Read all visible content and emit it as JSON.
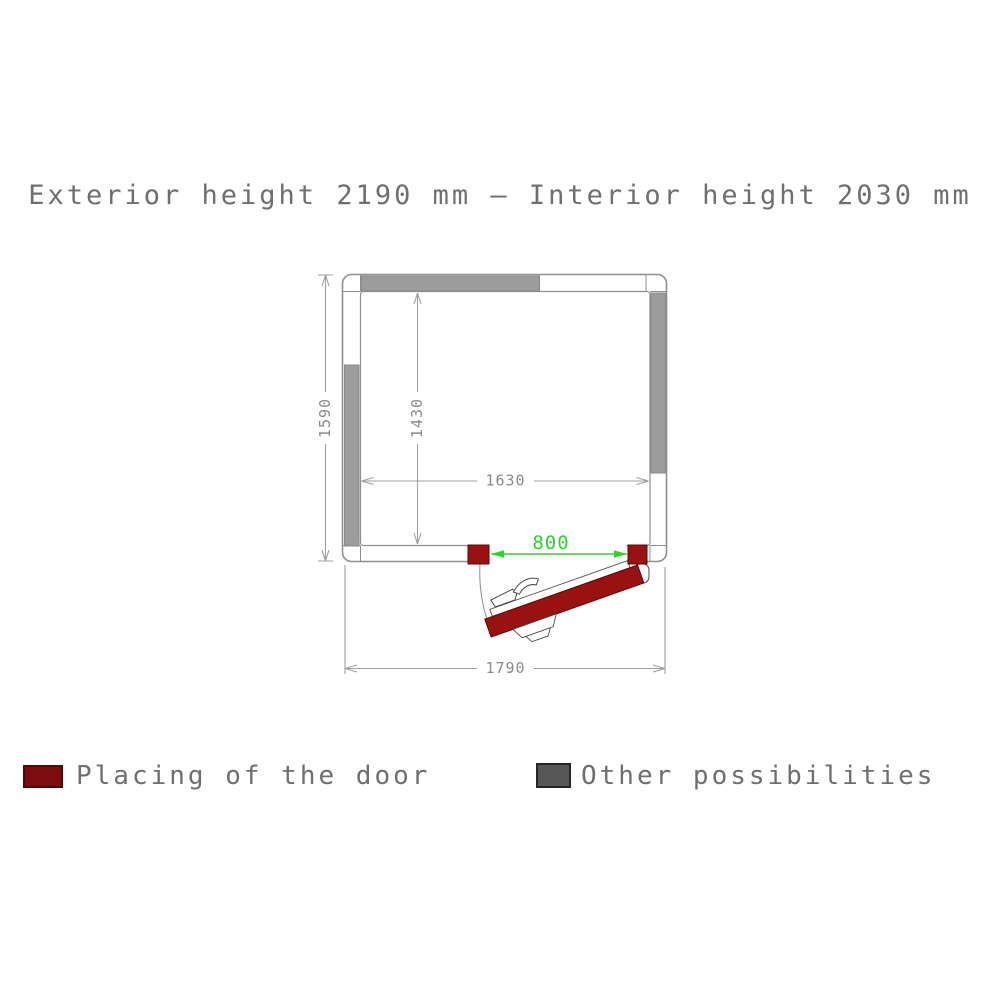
{
  "title": "Exterior height 2190 mm – Interior height 2030 mm",
  "plan": {
    "dim_exterior_width": "1790",
    "dim_exterior_depth": "1590",
    "dim_interior_width": "1630",
    "dim_interior_depth": "1430",
    "dim_door_opening": "800"
  },
  "legend": {
    "door_label": "Placing of the door",
    "other_label": "Other possibilities"
  },
  "colors": {
    "door-red": "#9a1111",
    "door-red-dark": "#5c0808",
    "legend-red": "#7d0d0d",
    "legend-red-border": "#4f0707",
    "bar-gray": "#9c9c9c",
    "bar-gray-border": "#8a8a8a",
    "legend-gray": "#575757",
    "legend-gray-border": "#262626",
    "dim-green": "#2ed32e",
    "line-gray": "#8f8f8f",
    "dim-line-gray": "#9f9f9f",
    "dim-text-gray": "#8a8a8a",
    "text-gray": "#6f6f6f",
    "detail-line": "#4a4a4a"
  }
}
